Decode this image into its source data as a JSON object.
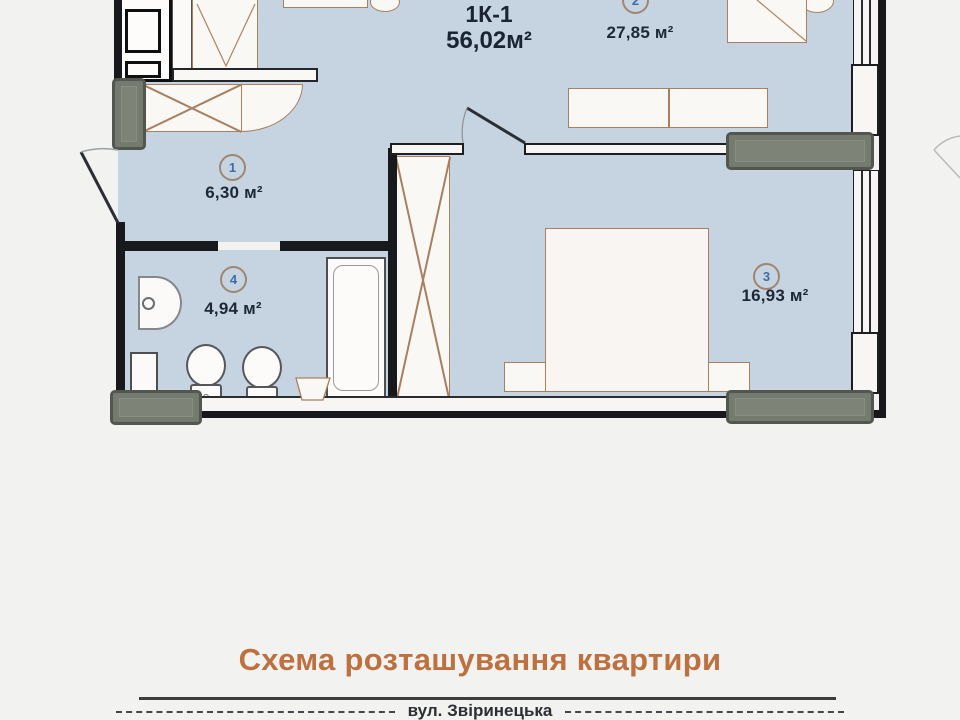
{
  "plan": {
    "title": "1К-1",
    "total_area": "56,02м²",
    "rooms": [
      {
        "number": "1",
        "area": "6,30 м²",
        "name": "hallway"
      },
      {
        "number": "2",
        "area": "27,85 м²",
        "name": "kitchen-living-room"
      },
      {
        "number": "3",
        "area": "16,93 м²",
        "name": "bedroom"
      },
      {
        "number": "4",
        "area": "4,94 м²",
        "name": "bathroom"
      }
    ]
  },
  "footer": {
    "caption": "Схема розташування квартири",
    "street": "вул. Звіринецька"
  },
  "colors": {
    "room_fill": "#c6d4e2",
    "wall": "#17191c",
    "furniture_outline": "#a97f60",
    "window_sill": "#757a6f",
    "caption_accent": "#bd7140",
    "room_number": "#3d6da3",
    "label_text": "#1d2834"
  }
}
